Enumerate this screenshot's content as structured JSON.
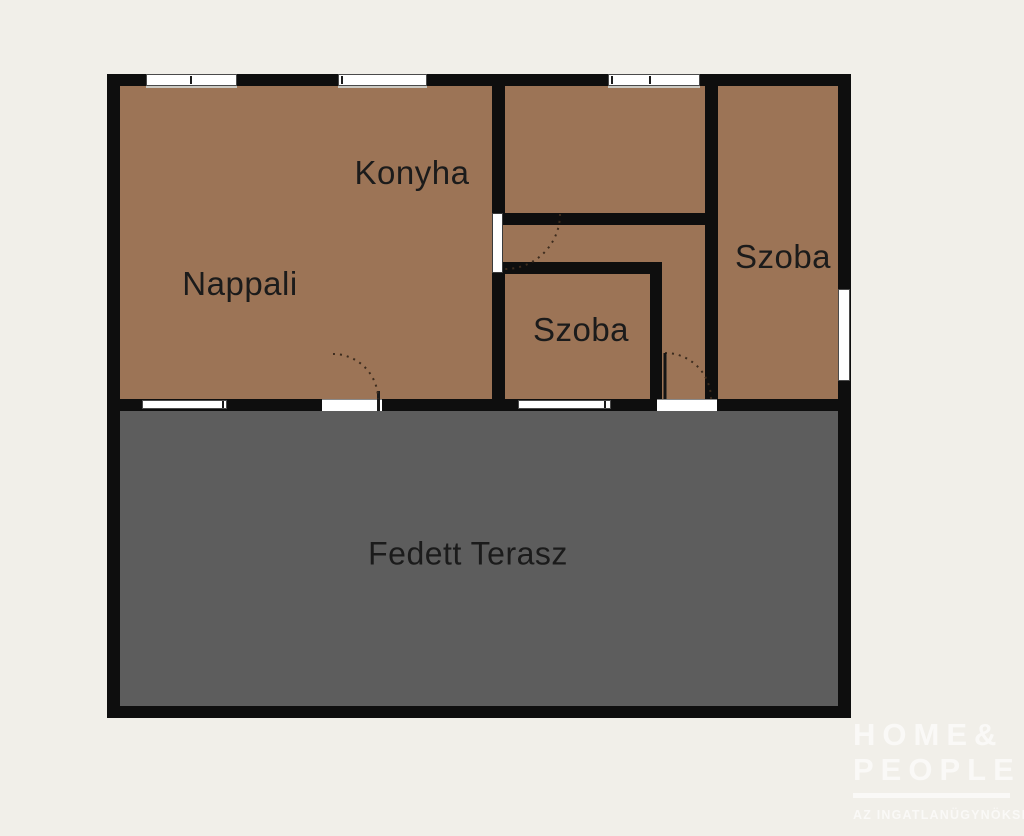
{
  "plan": {
    "rooms": {
      "konyha": "Konyha",
      "nappali": "Nappali",
      "szoba_small": "Szoba",
      "szoba_right": "Szoba",
      "terrace": "Fedett Terasz"
    },
    "colors": {
      "background": "#F1EFE9",
      "room_fill": "#9C7456",
      "terrace_fill": "#5D5D5D",
      "wall": "#0E0E0E",
      "label_text": "#1B1B1B",
      "watermark_white": "rgba(255,255,255,0.62)"
    },
    "watermark": {
      "brand_line1": "HOME&",
      "brand_line2": "PEOPLE",
      "tagline": "AZ INGATLANÜGYNÖKSÉG"
    }
  }
}
